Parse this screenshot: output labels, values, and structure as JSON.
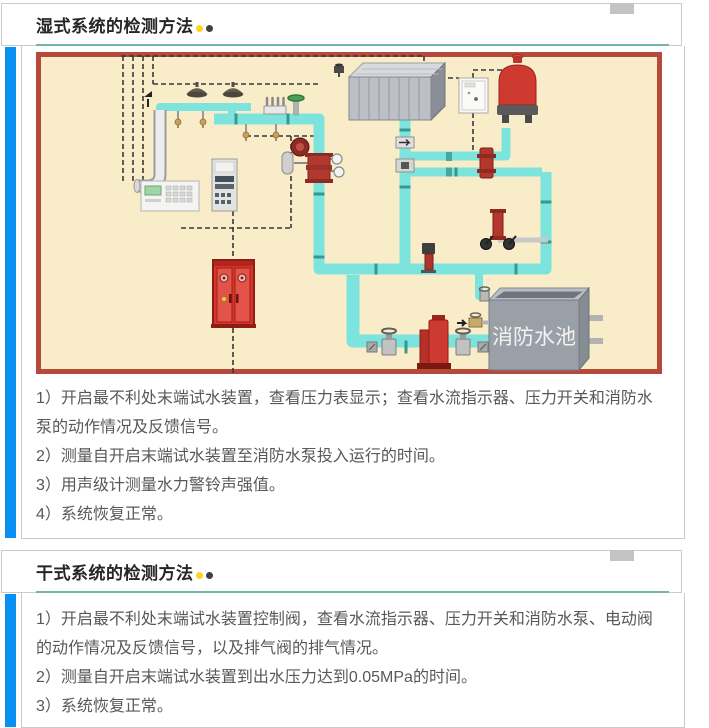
{
  "sections": [
    {
      "title": "湿式系统的检测方法",
      "items": [
        "1）开启最不利处末端试水装置，查看压力表显示；查看水流指示器、压力开关和消防水泵的动作情况及反馈信号。",
        "2）测量自开启末端试水装置至消防水泵投入运行的时间。",
        "3）用声级计测量水力警铃声强值。",
        "4）系统恢复正常。"
      ]
    },
    {
      "title": "干式系统的检测方法",
      "items": [
        "1）开启最不利处末端试水装置控制阀，查看水流指示器、压力开关和消防水泵、电动阀的动作情况及反馈信号，以及排气阀的排气情况。",
        "2）测量自开启末端试水装置到出水压力达到0.05MPa的时间。",
        "3）系统恢复正常。"
      ]
    }
  ],
  "diagram": {
    "pool_label": "消防水池"
  },
  "colors": {
    "accent_blue": "#0a8ff2",
    "divider_teal": "#75b3ad",
    "title_dot_yellow": "#ffd31f",
    "title_dot_dark": "#404040",
    "diagram_background": "#f8ecc9",
    "diagram_border": "#b5493b",
    "pipe_cyan": "#7de4dd"
  }
}
